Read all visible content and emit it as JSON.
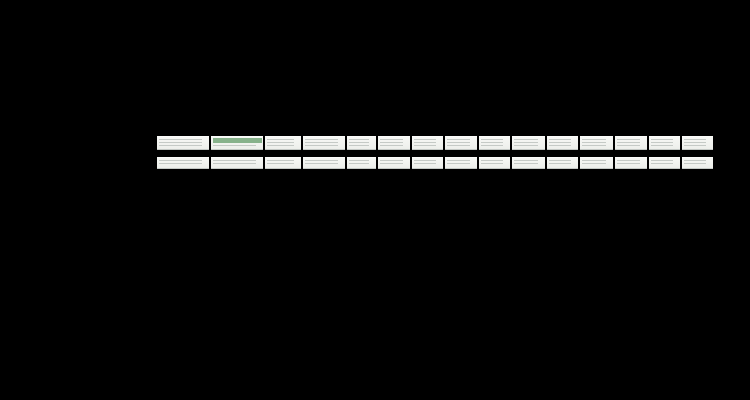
{
  "scene": {
    "background": "#000000",
    "brand": "SIVACON",
    "subject": "low-voltage power distribution switchboard lineup"
  },
  "palette": {
    "body": "#eef0ec",
    "stripBg": "#f3f4f1",
    "louverLine": "#c5cac6",
    "bandDark": "#122f4f",
    "bandMid": "#477fae",
    "bandLight": "#6f9dc1",
    "bandText": "#ffffff",
    "meshBase": "#dadcd6",
    "meshDot": "#949a94",
    "plinth": "#1a1d1f",
    "ledGreen": "#3fae4a",
    "ledYellow": "#d6c32a",
    "ledRed": "#d03a2e",
    "breakerFrame": "#141519",
    "breakerFace": "#969da3",
    "breakerLabel": "#3e6ca4",
    "mccbFace": "#c9cdc9",
    "screenFrame": "#402332",
    "screenBlue": "#3c66cb",
    "handle": "#141414",
    "stickerRed": "#6e1420",
    "stickerWhite": "#fbfcfa",
    "stickerGreen": "#2e7d3a",
    "stickerBlue": "#2a3f8f"
  },
  "lineup": {
    "top": 136,
    "cabinet_height": 155,
    "dist_top": 139,
    "dist_height": 149,
    "leds": [
      "ledGreen",
      "ledGreen",
      "ledYellow",
      "ledRed"
    ],
    "cabinets": [
      {
        "id": "cable-distribution",
        "type": "distribution",
        "x": 40,
        "w": 114,
        "label": "SIVACON"
      },
      {
        "id": "acb-feeder-1",
        "type": "acb",
        "x": 157,
        "w": 52,
        "label": "SIVACON"
      },
      {
        "id": "acb-feeder-2",
        "type": "acb_meter",
        "x": 211,
        "w": 52,
        "label": "SIVACON"
      },
      {
        "id": "control-metering",
        "type": "control",
        "x": 265,
        "w": 36,
        "label": "SIVACON"
      },
      {
        "id": "acb-feeder-3",
        "type": "acb",
        "x": 303,
        "w": 42,
        "label": "SIVACON"
      },
      {
        "id": "mccb-feeder-1",
        "type": "mccb2",
        "x": 347,
        "w": 29,
        "label": "SIVACON"
      },
      {
        "id": "mesh-door-1",
        "type": "mesh",
        "x": 378,
        "w": 32,
        "label": "SIVACON"
      },
      {
        "id": "mccb-feeder-2",
        "type": "mccb2",
        "x": 412,
        "w": 31,
        "label": "SIVACON"
      },
      {
        "id": "mesh-door-2",
        "type": "mesh",
        "x": 445,
        "w": 32,
        "label": "SIVACON"
      },
      {
        "id": "mccb-feeder-3",
        "type": "mccb2",
        "x": 479,
        "w": 31,
        "label": "SIVACON"
      },
      {
        "id": "mesh-door-3",
        "type": "mesh",
        "x": 512,
        "w": 33,
        "label": "SIVACON"
      },
      {
        "id": "mccb-feeder-4",
        "type": "mccb2",
        "x": 547,
        "w": 31,
        "label": "SIVACON"
      },
      {
        "id": "mesh-door-4",
        "type": "mesh",
        "x": 580,
        "w": 33,
        "label": "SIVACON"
      },
      {
        "id": "mcc-drawers-large",
        "type": "mcc",
        "x": 615,
        "w": 32,
        "drawers": 7,
        "label": "SIVACON"
      },
      {
        "id": "mcc-drawers-small",
        "type": "mcc",
        "x": 649,
        "w": 31,
        "drawers": 10,
        "label": "SIVACON"
      },
      {
        "id": "mcc-drawers-wide",
        "type": "mcc_b",
        "x": 682,
        "w": 31,
        "drawers": 10,
        "label": "SIVACON"
      }
    ],
    "distribution": {
      "seams": [
        15,
        62,
        93
      ],
      "stickers": [
        {
          "color": "stickerRed",
          "x": 32,
          "y": 46,
          "w": 4,
          "h": 12
        },
        {
          "color": "stickerWhite",
          "x": 37,
          "y": 47,
          "w": 15,
          "h": 11
        },
        {
          "color": "stickerGreen",
          "x": 69,
          "y": 45,
          "w": 4,
          "h": 12
        },
        {
          "color": "stickerGreen",
          "x": 74,
          "y": 46,
          "w": 3,
          "h": 11
        },
        {
          "color": "stickerBlue",
          "x": 80,
          "y": 46,
          "w": 4,
          "h": 11
        }
      ],
      "handle": {
        "x": 58,
        "y": 72,
        "w": 5,
        "h": 9
      },
      "window": {
        "x": 97,
        "y": 38,
        "w": 10,
        "h": 20
      }
    }
  }
}
